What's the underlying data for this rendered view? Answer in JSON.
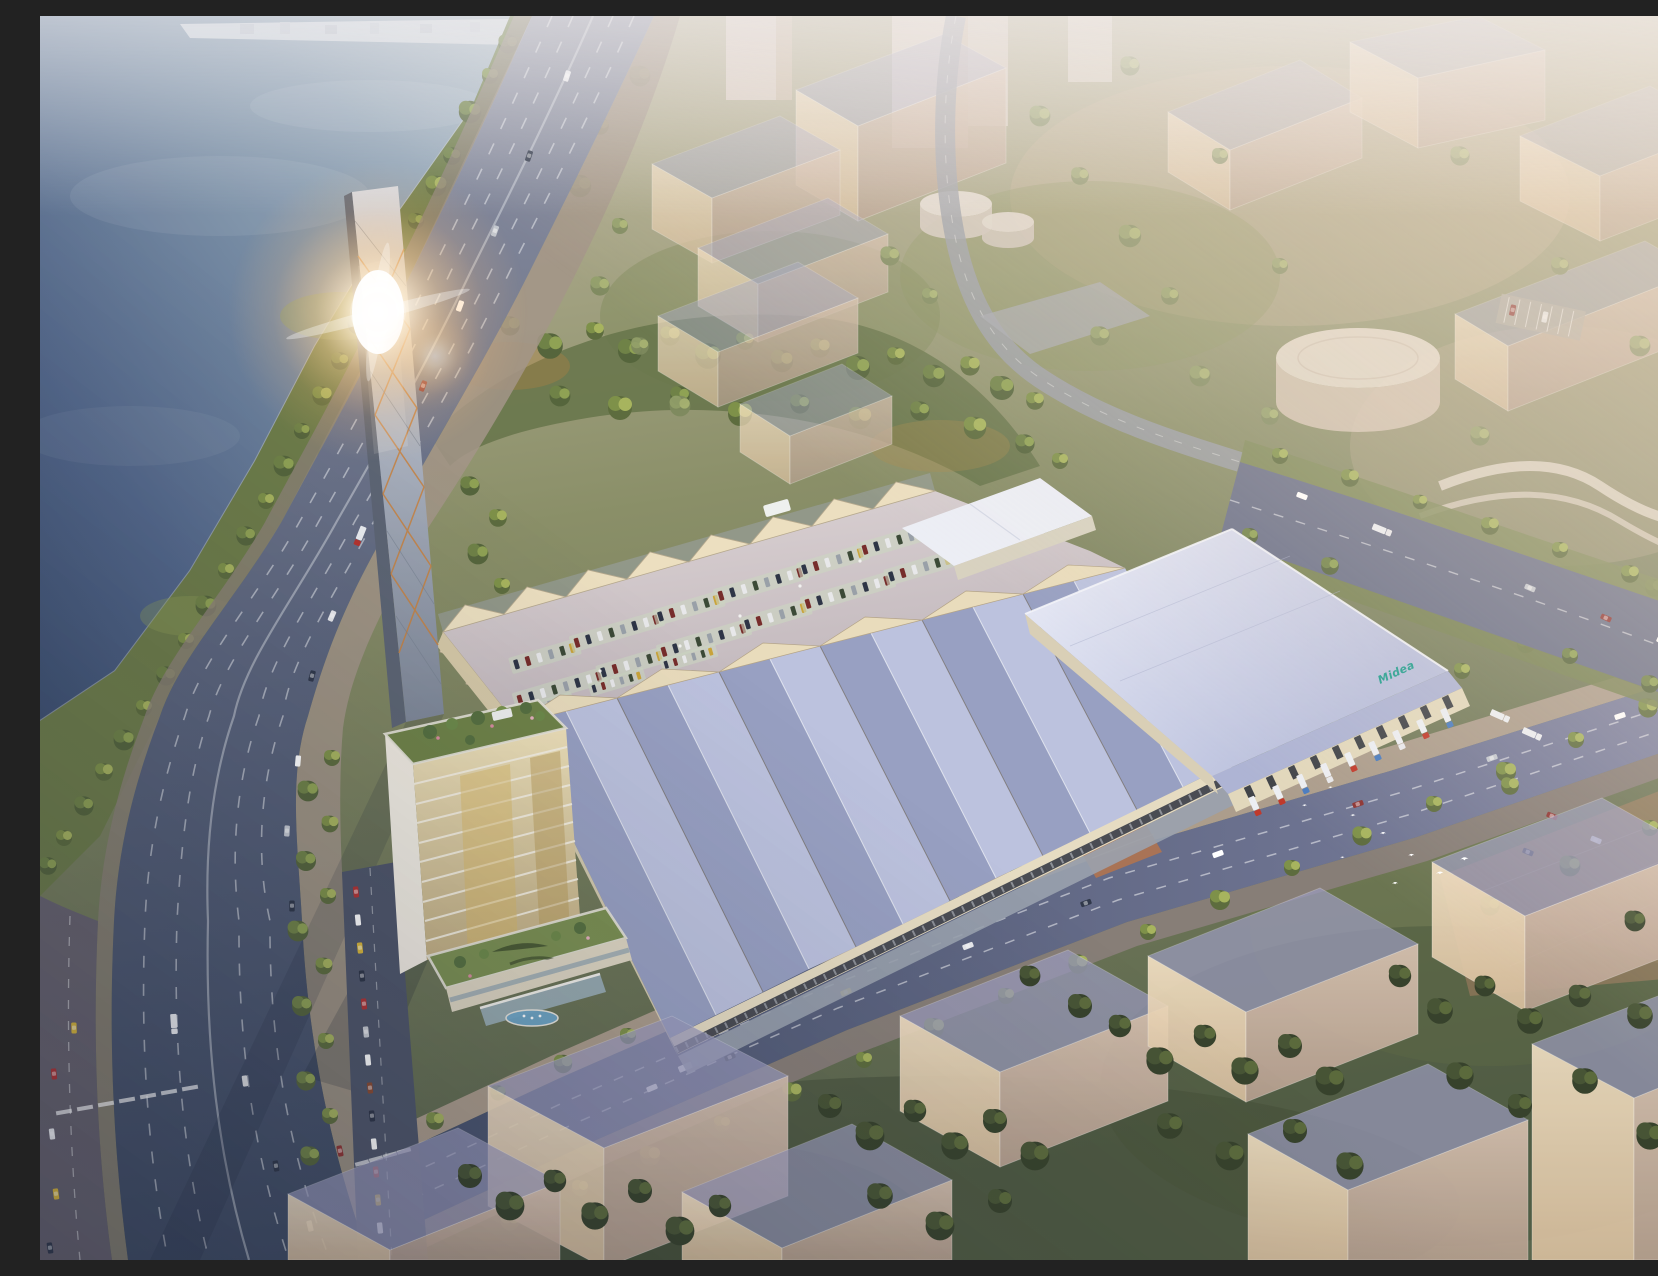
{
  "scene": {
    "type": "aerial-architectural-rendering",
    "description": "Aerial rendering of an industrial campus at hazy sunset: lake and curving multi-lane highway on the left, tall diagrid chimney tower with sun flare, office tower with roof gardens, rooftop parking deck with sawtooth skylights, ridged factory halls, large logistics warehouse with loading trucks, tree-lined boulevard, translucent ghost buildings and a flock of white birds."
  },
  "brand": {
    "logo_text": "Midea",
    "logo_color": "#1f9e8e"
  },
  "birds": {
    "count": 9
  },
  "palette": {
    "water_deep": "#3e5070",
    "water_light": "#a9b9c4",
    "haze_warm": "#f6e2cb",
    "asphalt": "#4a546c",
    "lane_marking": "#e8eaee",
    "hall_roof_light": "#bcc2de",
    "hall_roof_dark": "#98a0c2",
    "warehouse_roof": "#dfe2f2",
    "facade_cream": "#e9dcbc",
    "copper_accent": "#c8823f",
    "foliage_bright": "#a7b45e",
    "foliage_dark": "#37422c",
    "garden_green": "#7b9052",
    "truck_red": "#c0392b",
    "truck_blue": "#4a7cc0",
    "flare_core": "#ffffff"
  }
}
